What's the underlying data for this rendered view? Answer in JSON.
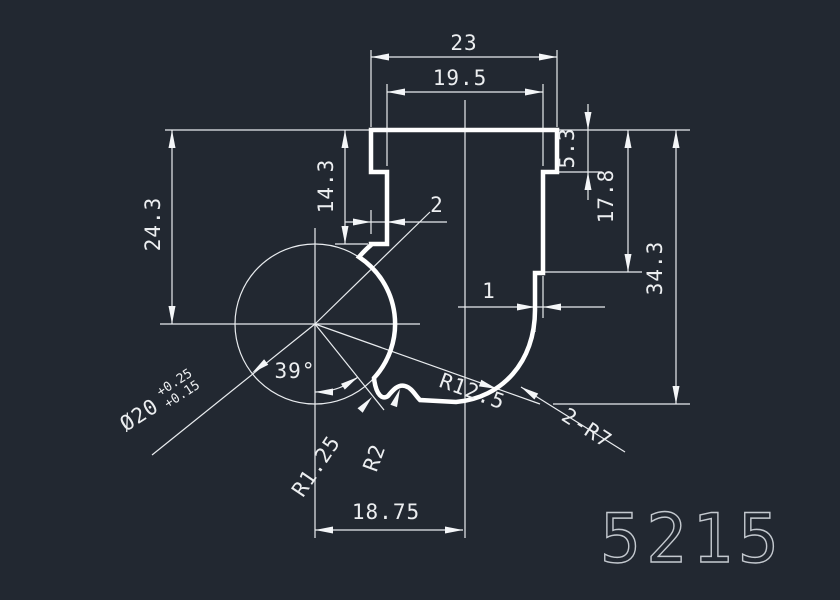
{
  "canvas": {
    "background": "#222831",
    "profile_line_color": "#ffffff",
    "dimension_line_color": "#e9ecef",
    "text_color": "#eceef0",
    "part_number_color": "#c4c9cf"
  },
  "part": {
    "number": "5215"
  },
  "dimensions": {
    "top_width_outer": "23",
    "top_width_inner": "19.5",
    "right_notch_depth": "5.3",
    "right_mid_depth": "17.8",
    "total_height": "34.3",
    "left_height_to_center": "24.3",
    "stem_height": "14.3",
    "stem_width": "2",
    "wall_offset": "1",
    "bottom_width": "18.75",
    "angle": "39°",
    "ball_diameter": "Ø20",
    "ball_tolerance_upper": "+0.25",
    "ball_tolerance_lower": "+0.15",
    "radius_cove": "R1.25",
    "radius_bump": "R2",
    "radius_inner": "R12.5",
    "radius_corners": "2-R7"
  }
}
